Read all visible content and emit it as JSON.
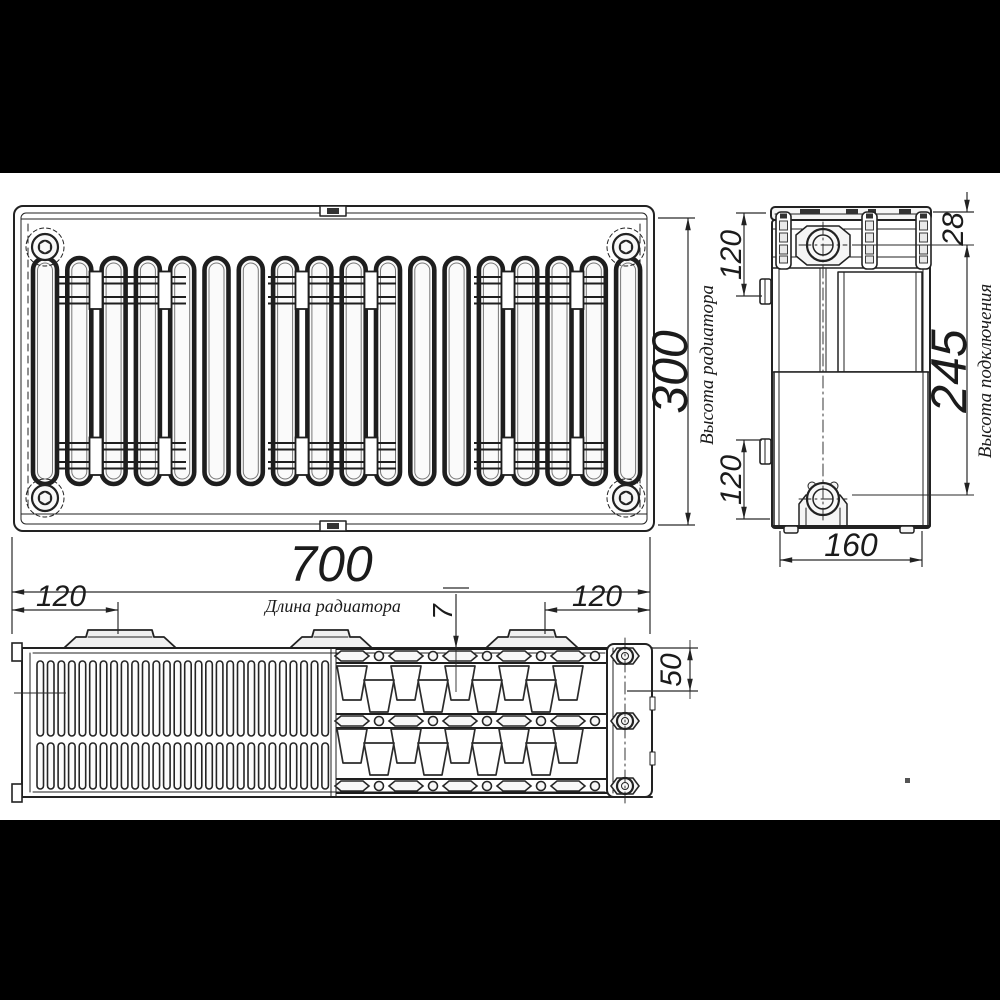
{
  "front_view": {
    "length": "700",
    "length_label": "Длина радиатора",
    "height": "300",
    "height_label": "Высота радиатора"
  },
  "side_view": {
    "bracket_offset_top": "120",
    "bracket_offset_bottom": "120",
    "top_connection_offset": "28",
    "connection_height": "245",
    "connection_height_label": "Высота подключения",
    "depth": "160"
  },
  "plan_view": {
    "bracket_offset_left": "120",
    "bracket_offset_right": "120",
    "panel_thickness": "7",
    "end_section_width": "50"
  },
  "colors": {
    "line": "#222222",
    "background": "#ffffff",
    "letterbox": "#000000"
  }
}
